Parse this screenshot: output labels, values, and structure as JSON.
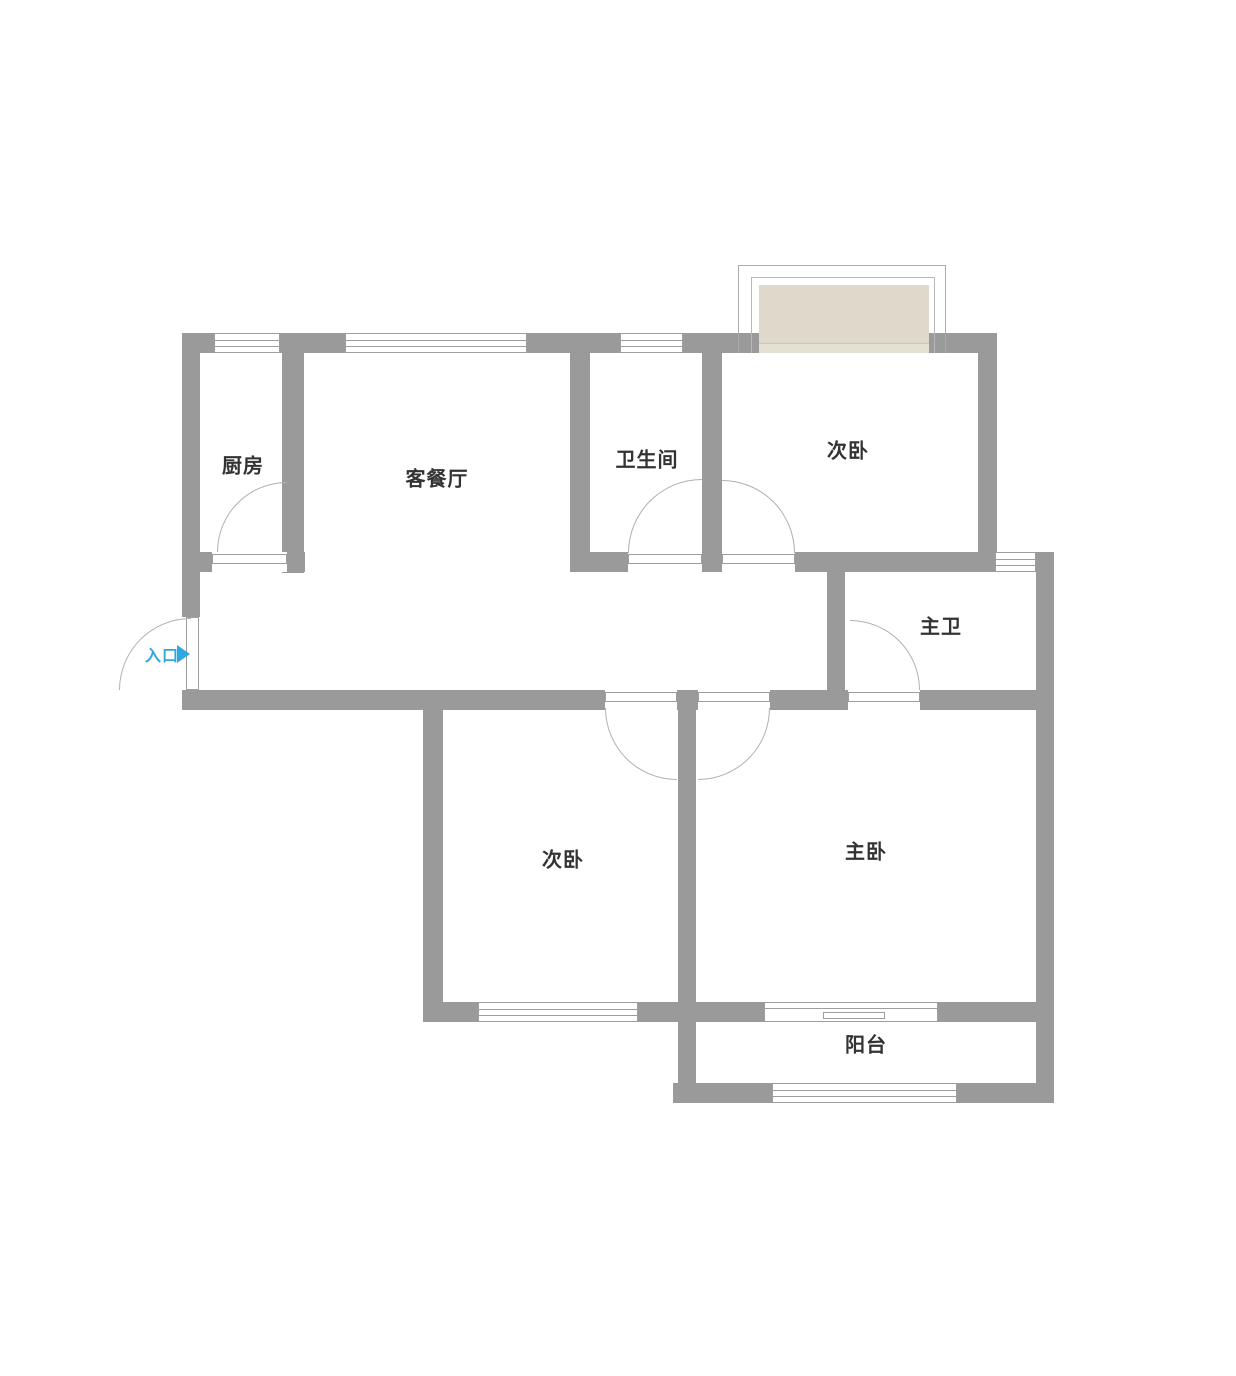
{
  "rooms": {
    "kitchen": {
      "label": "厨房"
    },
    "living_dining": {
      "label": "客餐厅"
    },
    "bathroom": {
      "label": "卫生间"
    },
    "bedroom_second_top": {
      "label": "次卧"
    },
    "master_bathroom": {
      "label": "主卫"
    },
    "bedroom_second_bottom": {
      "label": "次卧"
    },
    "master_bedroom": {
      "label": "主卧"
    },
    "balcony": {
      "label": "阳台"
    }
  },
  "entrance": {
    "label": "入口",
    "arrow_direction": "right"
  },
  "colors": {
    "wall": "#9a9a9b",
    "line": "#9e9e9e",
    "arc": "#b0b0b0",
    "bay_fill": "#ded9ca",
    "bay_sill": "#e4e0d3",
    "entrance": "#2fa8e2",
    "text": "#333333",
    "bg": "#ffffff"
  }
}
